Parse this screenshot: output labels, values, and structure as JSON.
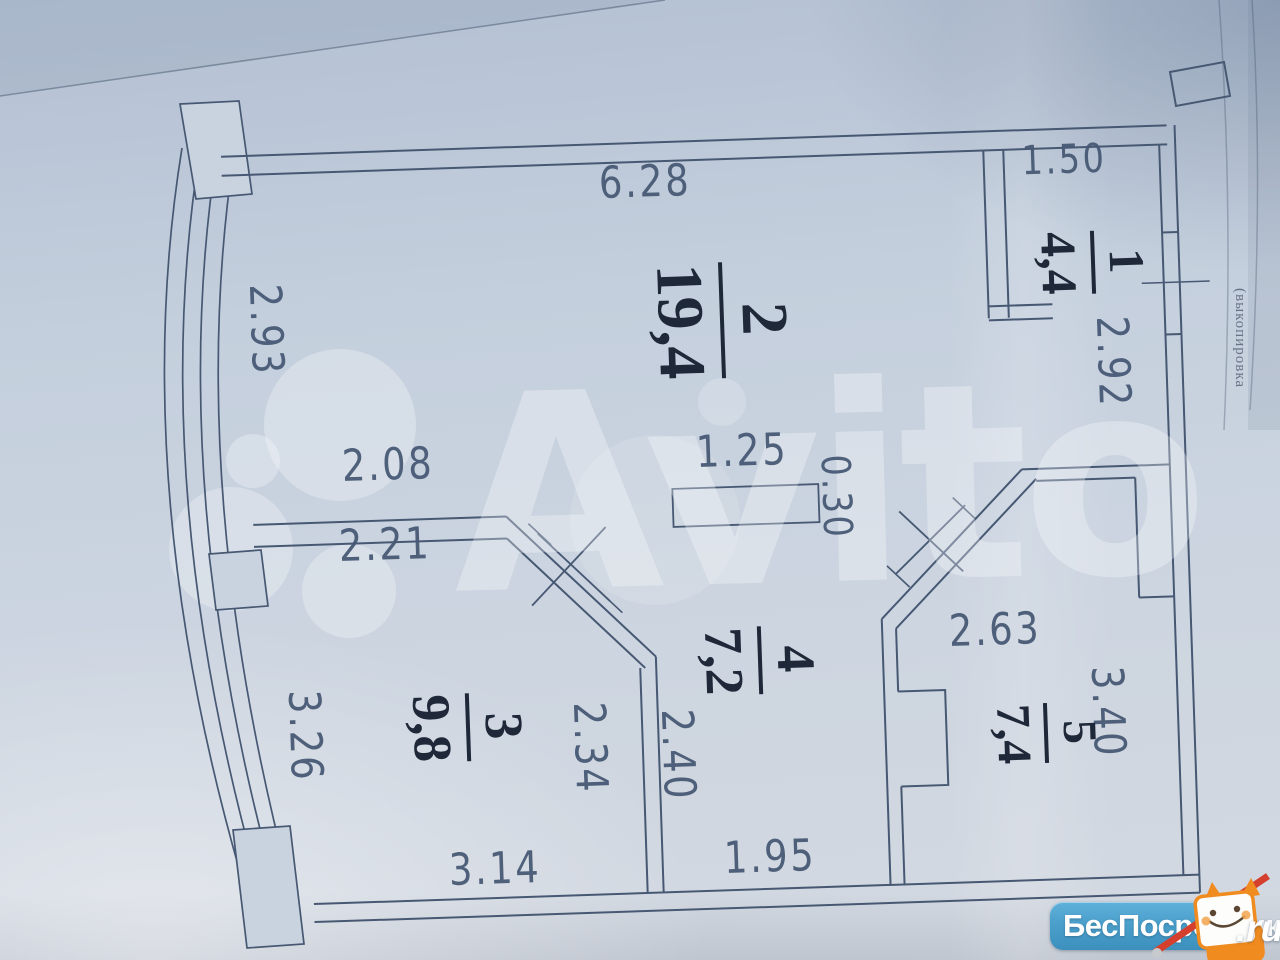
{
  "photo": {
    "watermark_brand": "Avito",
    "edge_note": "(выкопировка",
    "logo": {
      "name": "БесПосредника",
      "tld": ".ru"
    }
  },
  "floorplan": {
    "rooms": [
      {
        "number": "1",
        "area": "4,4"
      },
      {
        "number": "2",
        "area": "19,4"
      },
      {
        "number": "3",
        "area": "9,8"
      },
      {
        "number": "4",
        "area": "7,2"
      },
      {
        "number": "5",
        "area": "7,4"
      }
    ],
    "dimensions": {
      "top_wall": "6.28",
      "room1_width": "1.50",
      "room1_depth": "2.92",
      "balcony_window_room2": "2.93",
      "partition_a": "2.08",
      "partition_b": "2.21",
      "shaft_width": "1.25",
      "shaft_depth": "0.30",
      "room5_width": "2.63",
      "room5_depth": "3.40",
      "room3_side": "2.34",
      "room4_side": "2.40",
      "balcony_window_room3": "3.26",
      "room3_width": "3.14",
      "room4_width": "1.95"
    }
  }
}
